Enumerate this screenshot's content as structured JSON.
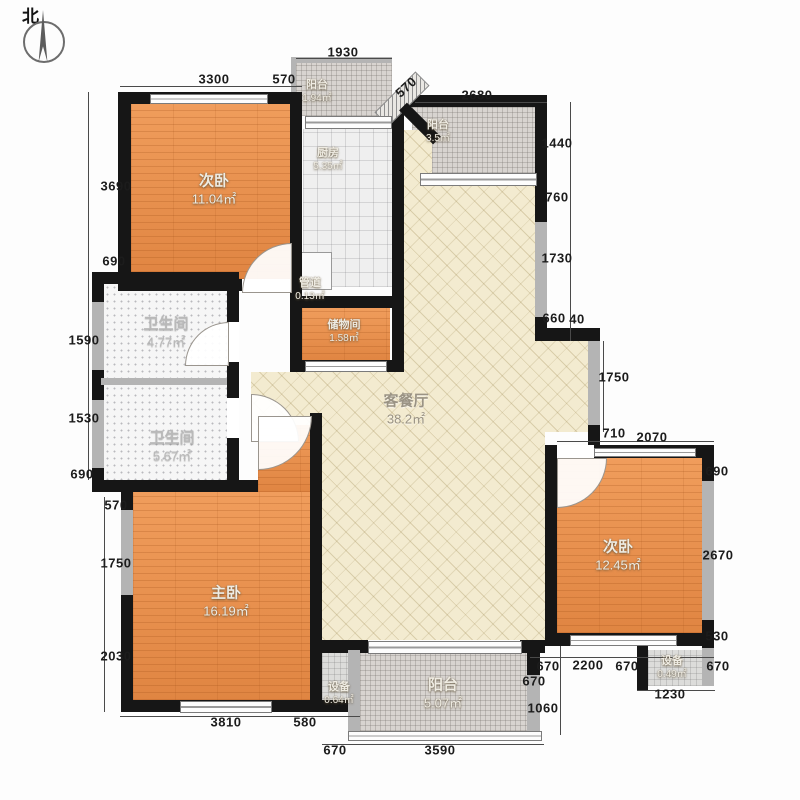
{
  "compass": {
    "label": "北"
  },
  "rooms": {
    "bedroom_tl": {
      "name": "次卧",
      "area": "11.04㎡"
    },
    "balcony_top": {
      "name": "阳台",
      "area": "1.94㎡"
    },
    "kitchen": {
      "name": "厨房",
      "area": "5.35㎡"
    },
    "balcony_tr": {
      "name": "阳台",
      "area": "3.5㎡"
    },
    "pipe": {
      "name": "管道",
      "area": "0.13㎡"
    },
    "storage": {
      "name": "储物间",
      "area": "1.58㎡"
    },
    "bath_upper": {
      "name": "卫生间",
      "area": "4.77㎡"
    },
    "bath_lower": {
      "name": "卫生间",
      "area": "5.67㎡"
    },
    "living": {
      "name": "客餐厅",
      "area": "38.2㎡"
    },
    "master": {
      "name": "主卧",
      "area": "16.19㎡"
    },
    "bedroom_r": {
      "name": "次卧",
      "area": "12.45㎡"
    },
    "equip_l": {
      "name": "设备",
      "area": "0.64㎡"
    },
    "balcony_b": {
      "name": "阳台",
      "area": "5.07㎡"
    },
    "equip_r": {
      "name": "设备",
      "area": "0.49㎡"
    }
  },
  "dims": {
    "top_1930": "1930",
    "top_3300": "3300",
    "top_570": "570",
    "diag_570": "570",
    "top_2680": "2680",
    "right_1440": "1440",
    "right_760": "760",
    "right_1730": "1730",
    "right_660": "660",
    "right_40": "40",
    "inner_1750": "1750",
    "inner_710": "710",
    "inner_2070": "2070",
    "rbr_690": "690",
    "rbr_2670": "2670",
    "rbr_530": "530",
    "rbr_670": "670",
    "left_3690": "3690",
    "left_690a": "690",
    "left_1590": "1590",
    "left_1530": "1530",
    "left_690b": "690",
    "left_570": "570",
    "left_1750": "1750",
    "left_2030": "2030",
    "bot_3810": "3810",
    "bot_580": "580",
    "bot_670": "670",
    "bot_3590": "3590",
    "row_670a": "670",
    "row_2200": "2200",
    "row_670b": "670",
    "col_670": "670",
    "col_1060": "1060",
    "bot_1230": "1230"
  },
  "colors": {
    "wall": "#161616",
    "wood_floor": "#e8914e",
    "living_floor": "#f3ebd0",
    "balcony_floor": "#d8d4d0",
    "dim_text": "#1c1c1c",
    "room_text": "#efece3"
  }
}
